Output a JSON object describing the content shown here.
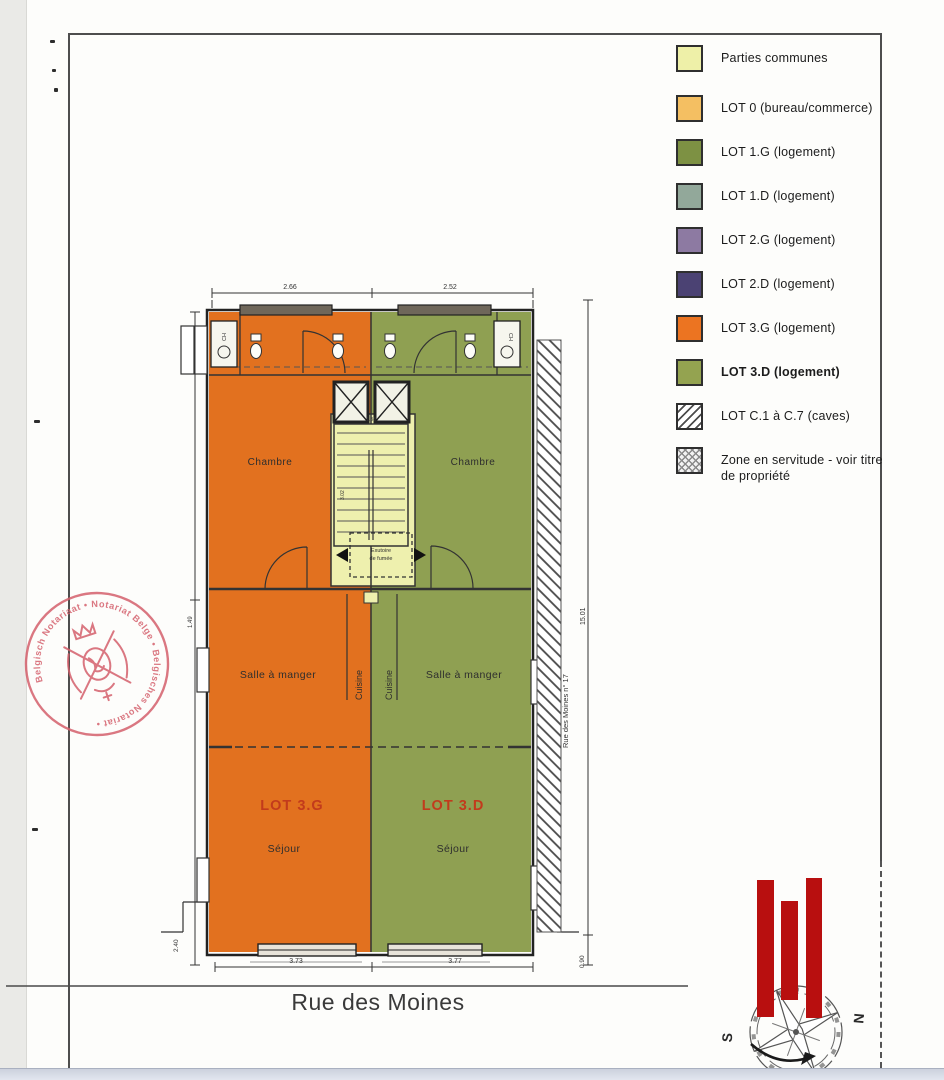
{
  "legend": {
    "items": [
      {
        "label": "Parties communes",
        "color": "#eef0a8",
        "pattern": "solid"
      },
      {
        "label": "LOT 0 (bureau/commerce)",
        "color": "#f4bf62",
        "pattern": "solid"
      },
      {
        "label": "LOT 1.G (logement)",
        "color": "#7d9143",
        "pattern": "solid"
      },
      {
        "label": "LOT 1.D (logement)",
        "color": "#92a89a",
        "pattern": "solid"
      },
      {
        "label": "LOT 2.G (logement)",
        "color": "#8d7aa2",
        "pattern": "solid"
      },
      {
        "label": "LOT 2.D (logement)",
        "color": "#4b4273",
        "pattern": "solid"
      },
      {
        "label": "LOT 3.G (logement)",
        "color": "#ec7421",
        "pattern": "solid"
      },
      {
        "label": "LOT 3.D (logement)",
        "color": "#94a350",
        "pattern": "solid",
        "bold": true
      },
      {
        "label": "LOT C.1 à C.7 (caves)",
        "pattern": "diagonal-hatch"
      },
      {
        "label": "Zone en servitude - voir titre de propriété",
        "pattern": "cross-hatch"
      }
    ]
  },
  "plan": {
    "street_label": "Rue des Moines",
    "rooms": {
      "chambre_left": "Chambre",
      "chambre_right": "Chambre",
      "salle_left": "Salle à manger",
      "salle_right": "Salle à manger",
      "cuisine_left": "Cuisine",
      "cuisine_right": "Cuisine",
      "lot_left": "LOT 3.G",
      "lot_right": "LOT 3.D",
      "sejour_left": "Séjour",
      "sejour_right": "Séjour",
      "smoke_vent_line1": "Exutoire",
      "smoke_vent_line2": "de fumée",
      "ch_left": "CH",
      "ch_right": "CH"
    },
    "dimensions": {
      "top_left": "2.66",
      "top_right": "2.52",
      "bottom_left": "3.73",
      "bottom_right": "3.77",
      "right_total": "15.01",
      "right_offset": "0.90",
      "left_upper": "1.49",
      "left_lower": "2.40",
      "stair_width": "1.38",
      "stair_height": "3.02",
      "street_side": "Rue des Moines n° 17"
    },
    "colors": {
      "lot_3g": "#e2711f",
      "lot_3d": "#8fa052",
      "common": "#eef0ae",
      "lot_label": "#c23b1c"
    }
  },
  "stamp": {
    "ring_text": "Belgisch Notariaat • Notariat Belge • Belgisches Notariat •",
    "color": "#d4606c"
  },
  "compass": {
    "north": "N",
    "south": "S"
  },
  "logo": {
    "bars_color": "#b80f0f"
  }
}
